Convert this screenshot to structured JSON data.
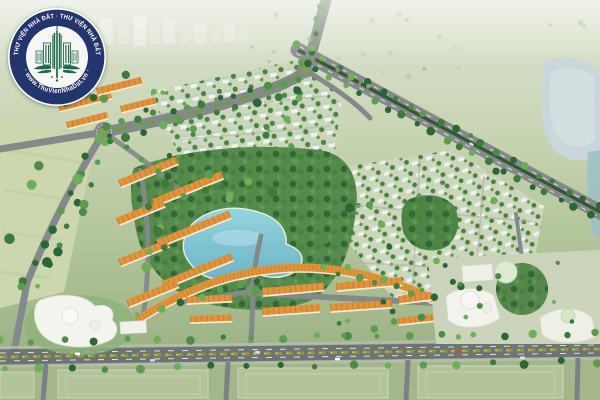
{
  "scene": {
    "type": "aerial-masterplan-render",
    "features": [
      "orange-roof shophouse rows",
      "white villa grids with trees",
      "central turquoise lake in wooded park",
      "tree-lined diagonal highway",
      "green-median boulevard with roundabouts",
      "white curved school building",
      "commercial center with round towers",
      "foreground boulevard with planted median",
      "open green fields and distant haze",
      "lake at right edge"
    ]
  },
  "watermark": {
    "ring_text_top": "THƯ VIỆN NHÀ ĐẤT · THƯ VIỆN NHÀ ĐẤT",
    "ring_text_bottom": "· www.ThuVienNhaDat.vn ·",
    "emblem_icon": "city-buildings-wings-icon"
  },
  "palette": {
    "logo_ring": "#23356d",
    "logo_inner": "#f6f7f5",
    "logo_emblem": "#1e6b4c",
    "logo_text": "#ffffff",
    "roof_orange": "#e0943c",
    "roof_orange_dark": "#bf7320",
    "lake_turquoise": "#7fc6d4",
    "lake_pale": "#c9d7da",
    "road_gray": "#84898a",
    "median_green": "#6e9a49",
    "shrub_yellow": "#9aa03a",
    "tree_dark": "#2c6536",
    "tree_mid": "#4c8c46",
    "field_pale": "#ccd7b0",
    "villa_white": "#f1f2ec",
    "building_white": "#f3f4ee",
    "haze_green": "#dde3d2"
  }
}
